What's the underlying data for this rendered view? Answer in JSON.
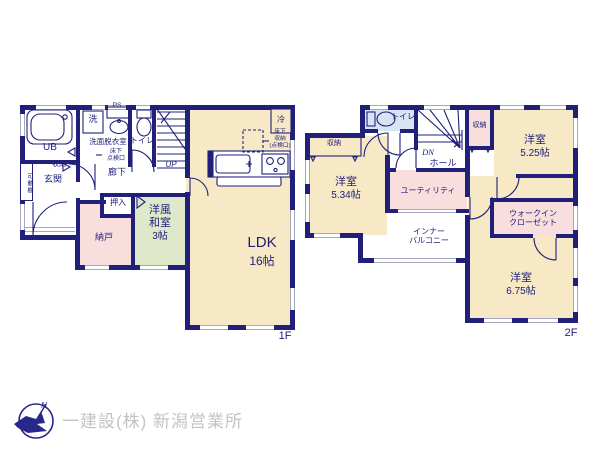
{
  "colors": {
    "wall": "#20207a",
    "room_cream": "#f7e9c6",
    "room_green": "#dfe9c9",
    "room_pink": "#f9dede",
    "room_blue": "#d6e4f3",
    "label_text": "#20207a",
    "footer_text": "#c3c3c3",
    "logo": "#28288c"
  },
  "floor1": {
    "floor_label": "1F",
    "unit_bath": "UB",
    "washer": "洗",
    "pipe_space": "PS",
    "washroom": "洗面脱衣室",
    "inspection_line1": "床下",
    "inspection_line2": "点検口",
    "toilet": "トイレ",
    "stairs_up": "UP",
    "hallway": "廊下",
    "movable_shelf": "可動棚",
    "entrance_storage": "収納",
    "entrance": "玄関",
    "closet": "押入",
    "storeroom": "納戸",
    "japanese_room_line1": "洋風",
    "japanese_room_line2": "和室",
    "japanese_room_size": "3帖",
    "ldk": "LDK",
    "ldk_size": "16帖",
    "fridge": "冷",
    "floor_storage_line1": "床下",
    "floor_storage_line2": "収納",
    "floor_storage_line3": "(点検口)"
  },
  "floor2": {
    "floor_label": "2F",
    "toilet": "トイレ",
    "stairs_down": "DN",
    "hall": "ホール",
    "storage_top": "収納",
    "storage_left": "収納",
    "bedroom_a": "洋室",
    "bedroom_a_size": "5.25帖",
    "bedroom_b": "洋室",
    "bedroom_b_size": "5.34帖",
    "utility": "ユーティリティ",
    "inner_balcony_line1": "インナー",
    "inner_balcony_line2": "バルコニー",
    "wic_line1": "ウォークイン",
    "wic_line2": "クローゼット",
    "bedroom_c": "洋室",
    "bedroom_c_size": "6.75帖"
  },
  "footer": {
    "company": "一建設(株) 新潟営業所",
    "compass_north": "N"
  }
}
